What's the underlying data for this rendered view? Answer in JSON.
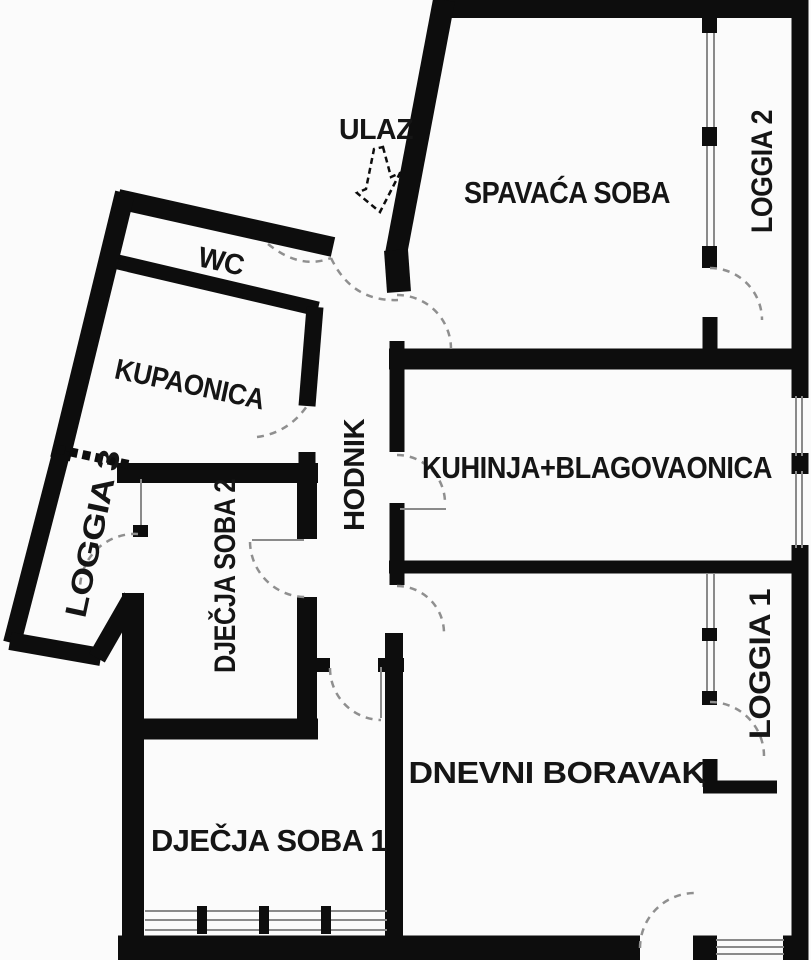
{
  "colors": {
    "wall": "#0d0d0d",
    "background": "#fbfbfb",
    "thin_line": "#8a8a8a",
    "dash": "#8f8f8f",
    "text": "#151515"
  },
  "rooms": {
    "ulaz": {
      "label": "ULAZ"
    },
    "spavaca_soba": {
      "label": "SPAVAĆA SOBA"
    },
    "loggia_2": {
      "label": "LOGGIA 2"
    },
    "wc": {
      "label": "WC"
    },
    "kupaonica": {
      "label": "KUPAONICA"
    },
    "hodnik": {
      "label": "HODNIK"
    },
    "kuhinja_blagovaonica": {
      "label": "KUHINJA+BLAGOVAONICA"
    },
    "loggia_3": {
      "label": "LOGGIA 3"
    },
    "djecja_soba_2": {
      "label": "DJEČJA SOBA 2"
    },
    "loggia_1": {
      "label": "LOGGIA 1"
    },
    "dnevni_boravak": {
      "label": "DNEVNI BORAVAK"
    },
    "djecja_soba_1": {
      "label": "DJEČJA SOBA 1"
    }
  }
}
